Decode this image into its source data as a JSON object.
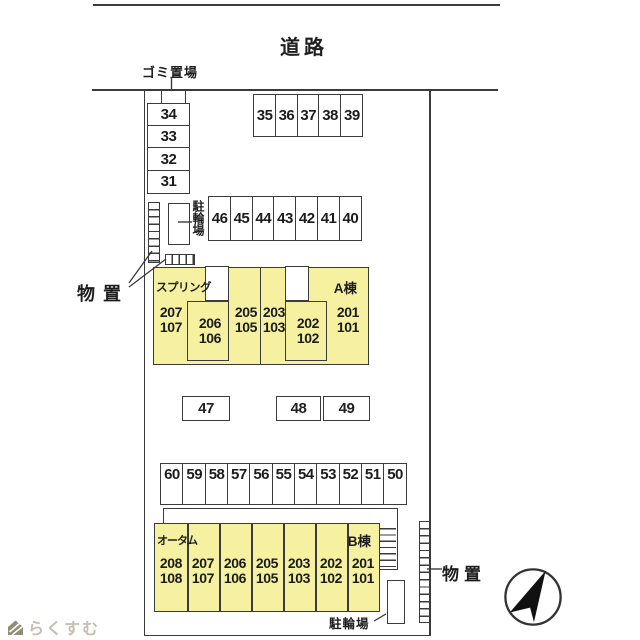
{
  "road": {
    "label": "道路"
  },
  "garbage": {
    "label": "ゴミ置場"
  },
  "storage": {
    "left_label": "物置",
    "right_label": "物置"
  },
  "bicycle": {
    "left_label": "駐輪場",
    "bottom_label": "駐輪場"
  },
  "parking": {
    "column_nw": [
      "34",
      "33",
      "32",
      "31"
    ],
    "row_north": [
      "35",
      "36",
      "37",
      "38",
      "39"
    ],
    "row_mid": [
      "46",
      "45",
      "44",
      "43",
      "42",
      "41",
      "40"
    ],
    "singles": [
      "47",
      "48",
      "49"
    ],
    "row_south": [
      "60",
      "59",
      "58",
      "57",
      "56",
      "55",
      "54",
      "53",
      "52",
      "51",
      "50"
    ]
  },
  "building_a": {
    "name": "スプリング",
    "block": "A棟",
    "units": [
      {
        "upper": "207",
        "lower": "107"
      },
      {
        "upper": "206",
        "lower": "106"
      },
      {
        "upper": "205",
        "lower": "105"
      },
      {
        "upper": "203",
        "lower": "103"
      },
      {
        "upper": "202",
        "lower": "102"
      },
      {
        "upper": "201",
        "lower": "101"
      }
    ]
  },
  "building_b": {
    "name": "オータム",
    "block": "B棟",
    "units": [
      {
        "upper": "208",
        "lower": "108"
      },
      {
        "upper": "207",
        "lower": "107"
      },
      {
        "upper": "206",
        "lower": "106"
      },
      {
        "upper": "205",
        "lower": "105"
      },
      {
        "upper": "203",
        "lower": "103"
      },
      {
        "upper": "202",
        "lower": "102"
      },
      {
        "upper": "201",
        "lower": "101"
      }
    ]
  },
  "logo": {
    "text": "らくすむ"
  },
  "colors": {
    "building_fill": "#f6f0a1",
    "line": "#3b3b3b",
    "logo_text": "#c6beb0",
    "logo_icon": "#8e8e74"
  }
}
